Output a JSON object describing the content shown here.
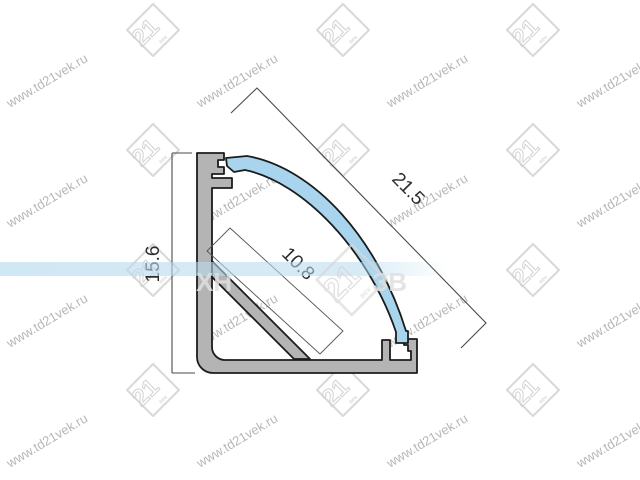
{
  "dimensions": {
    "height_label": "15.6",
    "diagonal_label": "21.5",
    "inner_width_label": "10.8"
  },
  "watermark": {
    "site_text": "www.td21vek.ru",
    "logo_text": "21",
    "logo_sub_text": "век",
    "center_text_left": "ХН",
    "center_text_right": "ЗВ"
  },
  "colors": {
    "aluminum_fill": "#b4b4b4",
    "outline": "#1c1c1c",
    "diffuser_blue": "#a8d4ee",
    "dimension_line": "#4a4a4a",
    "dimension_text": "#2d2d2d",
    "watermark_gray": "#a6a6a6",
    "watermark_logo_gray": "#d8d8d8",
    "stripe_blue": "#b7dbee"
  }
}
